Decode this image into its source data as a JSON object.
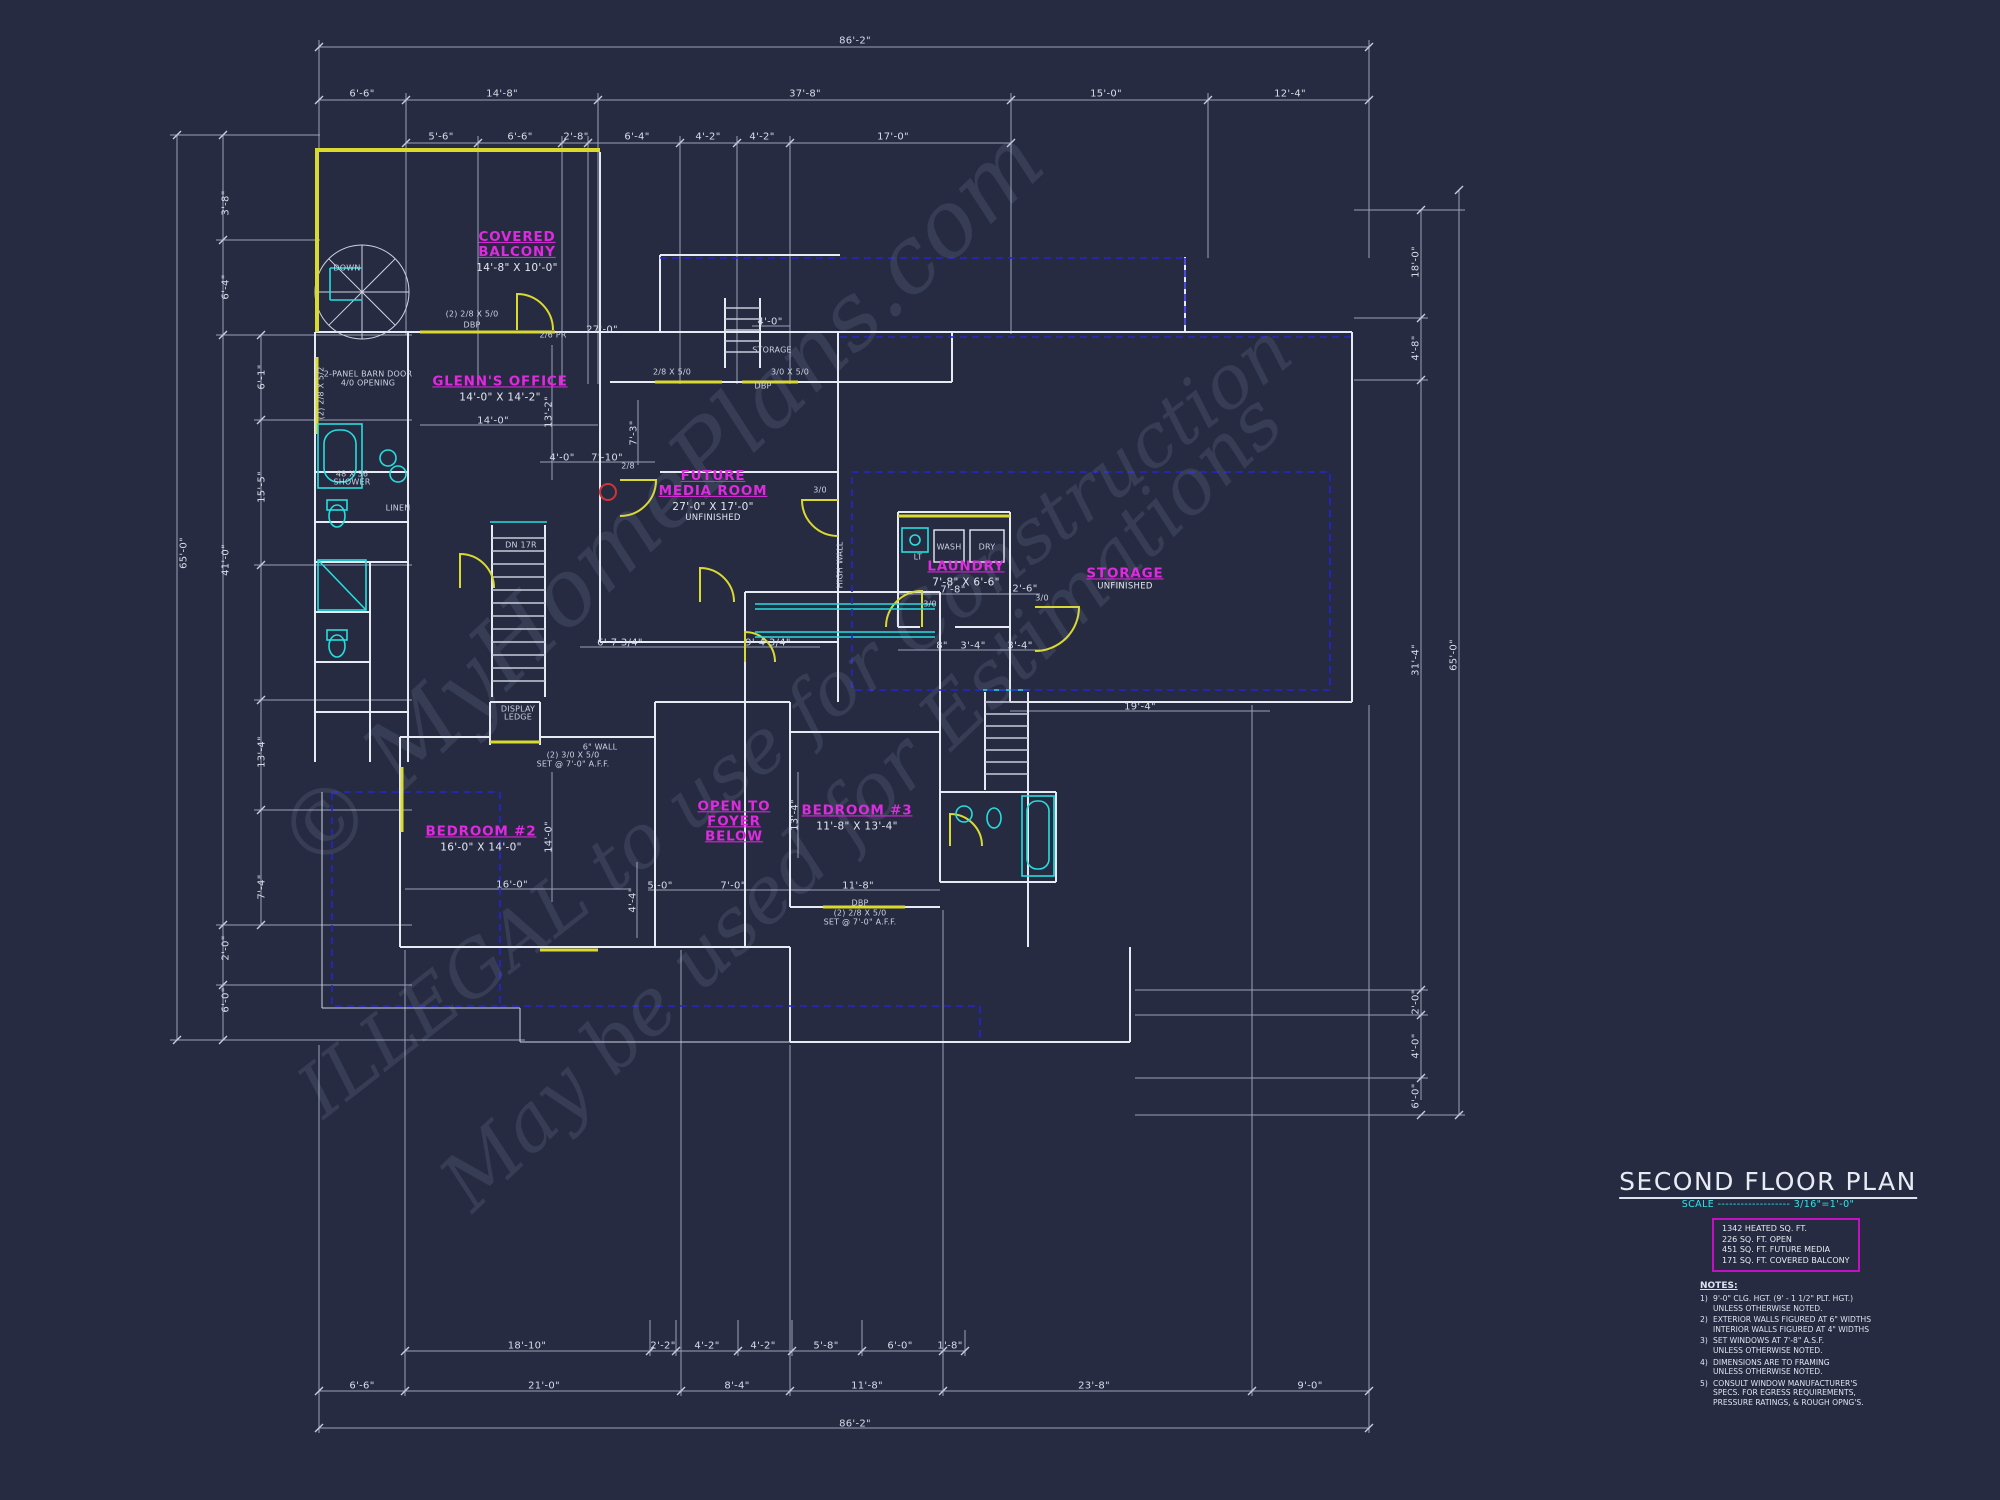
{
  "colors": {
    "background": "#262b42",
    "dimension_lines": "#aeb6c8",
    "walls_white": "#e6eaf3",
    "accent_yellow": "#d9d930",
    "accent_cyan": "#25dede",
    "accent_magenta": "#e02ae0",
    "accent_blue": "#2424cf",
    "accent_red": "#d03434"
  },
  "watermark": {
    "line1": "© MyHomePlans.com",
    "line2": "ILLEGAL to use for Construction",
    "line3": "May be used for Estimations"
  },
  "title_block": {
    "title": "SECOND FLOOR PLAN",
    "scale": "SCALE ------------------- 3/16\"=1'-0\"",
    "area_lines": [
      "1342 HEATED SQ. FT.",
      "226 SQ. FT. OPEN",
      "451 SQ. FT. FUTURE MEDIA",
      "171 SQ. FT. COVERED BALCONY"
    ],
    "notes_heading": "NOTES:",
    "notes": [
      {
        "num": "1)",
        "text": "9'-0\" CLG. HGT. (9' - 1 1/2\" PLT. HGT.)\nUNLESS OTHERWISE NOTED."
      },
      {
        "num": "2)",
        "text": "EXTERIOR WALLS FIGURED AT 6\" WIDTHS\nINTERIOR WALLS FIGURED AT 4\" WIDTHS"
      },
      {
        "num": "3)",
        "text": "SET WINDOWS AT 7'-8\" A.S.F.\nUNLESS OTHERWISE NOTED."
      },
      {
        "num": "4)",
        "text": "DIMENSIONS ARE TO FRAMING\nUNLESS OTHERWISE NOTED."
      },
      {
        "num": "5)",
        "text": "CONSULT WINDOW MANUFACTURER'S\nSPECS. FOR EGRESS REQUIREMENTS,\nPRESSURE RATINGS, & ROUGH OPNG'S."
      }
    ]
  },
  "plan": {
    "rooms": [
      {
        "name": "COVERED\nBALCONY",
        "dims": "14'-8\" X 10'-0\"",
        "x": 517,
        "y": 252
      },
      {
        "name": "GLENN'S OFFICE",
        "dims": "14'-0\" X 14'-2\"",
        "x": 500,
        "y": 389
      },
      {
        "name": "FUTURE\nMEDIA ROOM",
        "dims": "27'-0\" X 17'-0\"",
        "extra": "UNFINISHED",
        "x": 713,
        "y": 496
      },
      {
        "name": "LAUNDRY",
        "dims": "7'-8\" X 6'-6\"",
        "x": 966,
        "y": 574
      },
      {
        "name": "STORAGE",
        "extra": "UNFINISHED",
        "x": 1125,
        "y": 579
      },
      {
        "name": "BEDROOM #2",
        "dims": "16'-0\" X 14'-0\"",
        "x": 481,
        "y": 839
      },
      {
        "name": "OPEN TO\nFOYER\nBELOW",
        "x": 734,
        "y": 822
      },
      {
        "name": "BEDROOM #3",
        "dims": "11'-8\" X 13'-4\"",
        "x": 857,
        "y": 818
      }
    ],
    "dim_labels": [
      {
        "t": "86'-2\"",
        "x": 855,
        "y": 41
      },
      {
        "t": "6'-6\"",
        "x": 362,
        "y": 94
      },
      {
        "t": "14'-8\"",
        "x": 502,
        "y": 94
      },
      {
        "t": "37'-8\"",
        "x": 805,
        "y": 94
      },
      {
        "t": "15'-0\"",
        "x": 1106,
        "y": 94
      },
      {
        "t": "12'-4\"",
        "x": 1290,
        "y": 94
      },
      {
        "t": "5'-6\"",
        "x": 441,
        "y": 137
      },
      {
        "t": "6'-6\"",
        "x": 520,
        "y": 137
      },
      {
        "t": "2'-8\"",
        "x": 576,
        "y": 137
      },
      {
        "t": "6'-4\"",
        "x": 637,
        "y": 137
      },
      {
        "t": "4'-2\"",
        "x": 708,
        "y": 137
      },
      {
        "t": "4'-2\"",
        "x": 762,
        "y": 137
      },
      {
        "t": "17'-0\"",
        "x": 893,
        "y": 137
      },
      {
        "t": "65'-0\"",
        "x": 184,
        "y": 553,
        "r": -90
      },
      {
        "t": "41'-0\"",
        "x": 226,
        "y": 560,
        "r": -90
      },
      {
        "t": "3'-8\"",
        "x": 226,
        "y": 203,
        "r": -90
      },
      {
        "t": "6'-4\"",
        "x": 226,
        "y": 287,
        "r": -90
      },
      {
        "t": "6'-1\"",
        "x": 262,
        "y": 377,
        "r": -90
      },
      {
        "t": "15'-5\"",
        "x": 262,
        "y": 487,
        "r": -90
      },
      {
        "t": "13'-4\"",
        "x": 262,
        "y": 752,
        "r": -90
      },
      {
        "t": "7'-4\"",
        "x": 262,
        "y": 887,
        "r": -90
      },
      {
        "t": "2'-0\"",
        "x": 226,
        "y": 948,
        "r": -90
      },
      {
        "t": "6'-0\"",
        "x": 226,
        "y": 1000,
        "r": -90
      },
      {
        "t": "18'-0\"",
        "x": 1416,
        "y": 262,
        "r": -90
      },
      {
        "t": "4'-8\"",
        "x": 1416,
        "y": 348,
        "r": -90
      },
      {
        "t": "31'-4\"",
        "x": 1416,
        "y": 660,
        "r": -90
      },
      {
        "t": "65'-0\"",
        "x": 1454,
        "y": 655,
        "r": -90
      },
      {
        "t": "2'-0\"",
        "x": 1416,
        "y": 1002,
        "r": -90
      },
      {
        "t": "4'-0\"",
        "x": 1416,
        "y": 1046,
        "r": -90
      },
      {
        "t": "6'-0\"",
        "x": 1416,
        "y": 1096,
        "r": -90
      },
      {
        "t": "18'-10\"",
        "x": 527,
        "y": 1346
      },
      {
        "t": "2'-2\"",
        "x": 663,
        "y": 1346
      },
      {
        "t": "4'-2\"",
        "x": 707,
        "y": 1346
      },
      {
        "t": "4'-2\"",
        "x": 763,
        "y": 1346
      },
      {
        "t": "5'-8\"",
        "x": 826,
        "y": 1346
      },
      {
        "t": "6'-0\"",
        "x": 900,
        "y": 1346
      },
      {
        "t": "1'-8\"",
        "x": 950,
        "y": 1346
      },
      {
        "t": "6'-6\"",
        "x": 362,
        "y": 1386
      },
      {
        "t": "21'-0\"",
        "x": 544,
        "y": 1386
      },
      {
        "t": "8'-4\"",
        "x": 737,
        "y": 1386
      },
      {
        "t": "11'-8\"",
        "x": 867,
        "y": 1386
      },
      {
        "t": "23'-8\"",
        "x": 1094,
        "y": 1386
      },
      {
        "t": "9'-0\"",
        "x": 1310,
        "y": 1386
      },
      {
        "t": "86'-2\"",
        "x": 855,
        "y": 1424
      },
      {
        "t": "14'-0\"",
        "x": 493,
        "y": 421
      },
      {
        "t": "13'-2\"",
        "x": 549,
        "y": 412,
        "r": -90
      },
      {
        "t": "27'-0\"",
        "x": 602,
        "y": 330
      },
      {
        "t": "4'-0\"",
        "x": 562,
        "y": 458
      },
      {
        "t": "7'-10\"",
        "x": 607,
        "y": 458
      },
      {
        "t": "7'-3\"",
        "x": 634,
        "y": 433,
        "r": -90
      },
      {
        "t": "7'-8\"",
        "x": 953,
        "y": 590
      },
      {
        "t": "2'-6\"",
        "x": 1025,
        "y": 589
      },
      {
        "t": "8\"",
        "x": 942,
        "y": 646
      },
      {
        "t": "3'-4\"",
        "x": 973,
        "y": 646
      },
      {
        "t": "3'-4\"",
        "x": 1020,
        "y": 646
      },
      {
        "t": "19'-4\"",
        "x": 1140,
        "y": 707
      },
      {
        "t": "16'-0\"",
        "x": 512,
        "y": 885
      },
      {
        "t": "14'-0\"",
        "x": 549,
        "y": 837,
        "r": -90
      },
      {
        "t": "4'-4\"",
        "x": 633,
        "y": 900,
        "r": -90
      },
      {
        "t": "5'-0\"",
        "x": 660,
        "y": 886
      },
      {
        "t": "7'-0\"",
        "x": 733,
        "y": 886
      },
      {
        "t": "11'-8\"",
        "x": 858,
        "y": 886
      },
      {
        "t": "13'-4\"",
        "x": 795,
        "y": 815,
        "r": -90
      },
      {
        "t": "6'-7 3/4\"",
        "x": 620,
        "y": 643
      },
      {
        "t": "9'-4 3/4\"",
        "x": 768,
        "y": 643
      },
      {
        "t": "4'-0\"",
        "x": 770,
        "y": 322
      }
    ],
    "annotations": [
      {
        "t": "DOWN",
        "x": 347,
        "y": 268
      },
      {
        "t": "(2) 2/8 X 5/0",
        "x": 472,
        "y": 314
      },
      {
        "t": "DBP",
        "x": 472,
        "y": 325
      },
      {
        "t": "2/8 X 5/0",
        "x": 672,
        "y": 372
      },
      {
        "t": "3/0 X 5/0",
        "x": 790,
        "y": 372
      },
      {
        "t": "DBP",
        "x": 763,
        "y": 386
      },
      {
        "t": "(2) 2/8 X 5/2",
        "x": 321,
        "y": 393,
        "r": -90
      },
      {
        "t": "2-PANEL BARN DOOR",
        "x": 368,
        "y": 374
      },
      {
        "t": "4/0 OPENING",
        "x": 368,
        "y": 383
      },
      {
        "t": "DN 17R",
        "x": 521,
        "y": 545
      },
      {
        "t": "STORAGE",
        "x": 772,
        "y": 350
      },
      {
        "t": "WASH",
        "x": 949,
        "y": 547
      },
      {
        "t": "DRY",
        "x": 987,
        "y": 547
      },
      {
        "t": "LT",
        "x": 918,
        "y": 557
      },
      {
        "t": "3/0",
        "x": 930,
        "y": 604
      },
      {
        "t": "3/0",
        "x": 1042,
        "y": 598
      },
      {
        "t": "3/0",
        "x": 820,
        "y": 490
      },
      {
        "t": "2/6 PR",
        "x": 553,
        "y": 335
      },
      {
        "t": "2/8",
        "x": 628,
        "y": 466
      },
      {
        "t": "LINEN",
        "x": 398,
        "y": 508
      },
      {
        "t": "48 X 36",
        "x": 352,
        "y": 474
      },
      {
        "t": "SHOWER",
        "x": 352,
        "y": 482
      },
      {
        "t": "DISPLAY",
        "x": 518,
        "y": 709
      },
      {
        "t": "LEDGE",
        "x": 518,
        "y": 717
      },
      {
        "t": "HIGH WALL",
        "x": 840,
        "y": 565,
        "r": -90
      },
      {
        "t": "6\" WALL",
        "x": 600,
        "y": 747
      },
      {
        "t": "(2) 3/0 X 5/0",
        "x": 573,
        "y": 755
      },
      {
        "t": "SET @ 7'-0\" A.F.F.",
        "x": 573,
        "y": 764
      },
      {
        "t": "DBP",
        "x": 860,
        "y": 903
      },
      {
        "t": "(2) 2/8 X 5/0",
        "x": 860,
        "y": 913
      },
      {
        "t": "SET @ 7'-0\" A.F.F.",
        "x": 860,
        "y": 922
      }
    ]
  }
}
